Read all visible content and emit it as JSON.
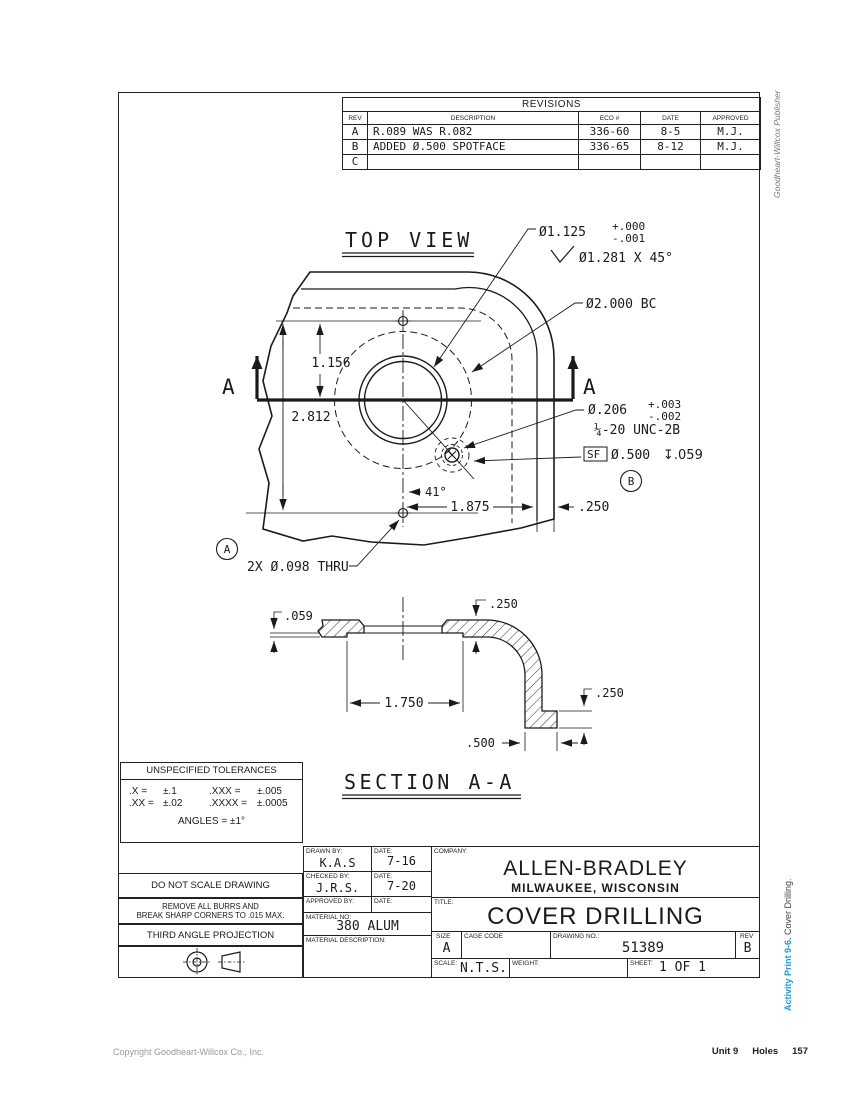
{
  "sheet": {
    "side_top": "Goodheart-Willcox Publisher",
    "side_bottom_accent": "Activity Print 9-6.",
    "side_bottom_rest": " Cover Drilling.",
    "footer_copyright": "Copyright Goodheart-Willcox Co., Inc.",
    "footer_unit": "Unit 9",
    "footer_section": "Holes",
    "footer_page": "157",
    "accent_color": "#1b9bce"
  },
  "revisions": {
    "title": "REVISIONS",
    "col_rev": "REV",
    "col_description": "DESCRIPTION",
    "col_eco": "ECO #",
    "col_date": "DATE",
    "col_approved": "APPROVED",
    "rows": [
      {
        "rev": "A",
        "description": "R.089 WAS R.082",
        "eco": "336-60",
        "date": "8-5",
        "approved": "M.J."
      },
      {
        "rev": "B",
        "description": "ADDED Ø.500 SPOTFACE",
        "eco": "336-65",
        "date": "8-12",
        "approved": "M.J."
      },
      {
        "rev": "C",
        "description": "",
        "eco": "",
        "date": "",
        "approved": ""
      }
    ]
  },
  "top_view": {
    "label": "TOP VIEW",
    "cut_letter": "A",
    "bore_dia": "Ø1.125",
    "bore_plus": "+.000",
    "bore_minus": "-.001",
    "chamfer": "Ø1.281 X 45°",
    "bolt_circle": "Ø2.000 BC",
    "tap_dia": "Ø.206",
    "tap_plus": "+.003",
    "tap_minus": "-.002",
    "thread": "¼-20 UNC-2B",
    "sf": "SF",
    "sf_dia": "Ø.500",
    "sf_depth": "↧.059",
    "balloon_b": "B",
    "balloon_a": "A",
    "angle": "41°",
    "dim_v1": "1.156",
    "dim_v2": "2.812",
    "dim_h1": "1.875",
    "dim_h2": ".250",
    "holes_note": "2X Ø.098 THRU"
  },
  "section": {
    "label": "SECTION A-A",
    "dim_step": ".059",
    "dim_thk": ".250",
    "dim_recess": "1.750",
    "dim_foot_h": ".250",
    "dim_foot_w": ".500"
  },
  "tolerances": {
    "title": "UNSPECIFIED TOLERANCES",
    "r1c1": ".X  =",
    "r1c2": "±.1",
    "r1c3": ".XXX  =",
    "r1c4": "±.005",
    "r2c1": ".XX =",
    "r2c2": "±.02",
    "r2c3": ".XXXX =",
    "r2c4": "±.0005",
    "angles": "ANGLES = ±1°"
  },
  "notes": {
    "no_scale": "DO NOT SCALE DRAWING",
    "burrs_1": "REMOVE ALL BURRS AND",
    "burrs_2": "BREAK SHARP CORNERS TO .015 MAX.",
    "projection": "THIRD ANGLE PROJECTION"
  },
  "title_block": {
    "drawn_label": "DRAWN BY:",
    "drawn": "K.A.S",
    "date_label": "DATE:",
    "drawn_date": "7-16",
    "checked_label": "CHECKED BY:",
    "checked": "J.R.S.",
    "checked_date": "7-20",
    "approved_label": "APPROVED BY:",
    "company_label": "COMPANY:",
    "company": "ALLEN-BRADLEY",
    "company_city": "MILWAUKEE, WISCONSIN",
    "title_label": "TITLE:",
    "title": "COVER DRILLING",
    "material_label": "MATERIAL NO:",
    "material": "380 ALUM",
    "material_desc_label": "MATERIAL DESCRIPTION:",
    "size_label": "SIZE",
    "size": "A",
    "cage_label": "CAGE CODE",
    "dwg_label": "DRAWING NO.:",
    "dwg_no": "51389",
    "rev_label": "REV",
    "rev": "B",
    "scale_label": "SCALE:",
    "scale": "N.T.S.",
    "weight_label": "WEIGHT:",
    "sheet_label": "SHEET:",
    "sheet": "1 OF 1"
  }
}
